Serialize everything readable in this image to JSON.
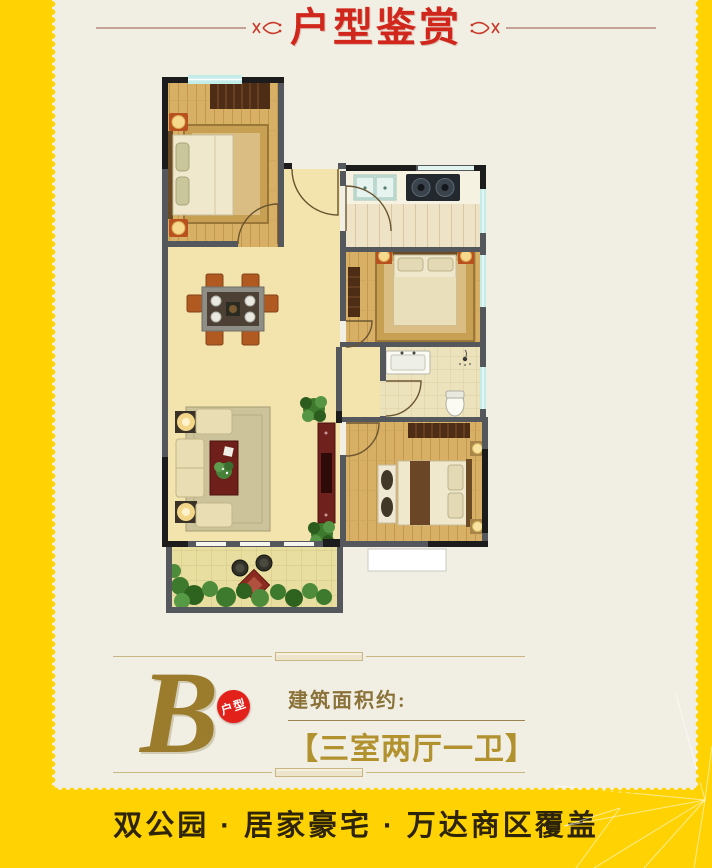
{
  "page": {
    "background": "#FFD303",
    "panel": "#F1EFE4"
  },
  "header": {
    "title": "户型鉴赏",
    "title_color": "#D0261B",
    "ornament_icon": "flourish"
  },
  "unit": {
    "letter": "B",
    "badge_label": "户型",
    "badge_color": "#E3211B",
    "gold_color": "#9A7C2C",
    "area_label": "建筑面积约:",
    "layout_name": "【三室两厅一卫】"
  },
  "footer": {
    "slogan": "双公园 · 居家豪宅 · 万达商区覆盖",
    "text_color": "#2E2407"
  },
  "floor_plan": {
    "type": "apartment-floor-plan",
    "rooms": [
      "bedroom-top-left",
      "entry-hall",
      "kitchen",
      "bedroom-right",
      "bathroom",
      "living-dining-room",
      "bedroom-bottom-right",
      "balcony"
    ],
    "fixtures": [
      "double-bed",
      "wardrobe",
      "kitchen-sink",
      "gas-stove",
      "bathroom-sink",
      "shower",
      "toilet",
      "dining-table-6-chairs",
      "sofa-set",
      "coffee-table",
      "tv-cabinet",
      "balcony-table-chairs",
      "plants"
    ]
  }
}
